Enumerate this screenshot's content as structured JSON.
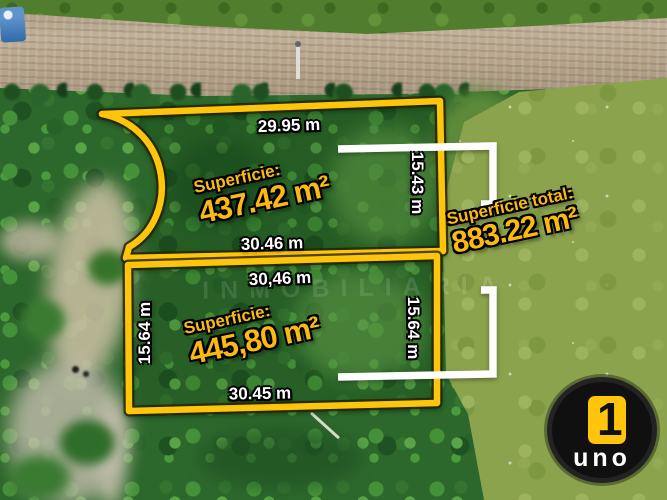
{
  "annotations": {
    "plot1": {
      "top_dim": "29.95 m",
      "right_dim": "15.43 m",
      "bottom_dim": "30.46 m",
      "area_label": "Superficie:",
      "area_value": "437.42 m²"
    },
    "plot2": {
      "top_dim": "30,46 m",
      "left_dim": "15.64 m",
      "right_dim": "15.64 m",
      "bottom_dim": "30.45 m",
      "area_label": "Superficie:",
      "area_value": "445,80 m²"
    },
    "total": {
      "label": "Superficie total:",
      "value": "883.22 m²"
    },
    "watermark": "INMOBILIARIA"
  },
  "logo": {
    "number": "1",
    "text": "uno"
  },
  "colors": {
    "boundary_yellow": "#FFC40C",
    "area_text_yellow": "#FCB912",
    "dimension_white": "#FFFFFF",
    "bracket_white": "#FFFFFF"
  }
}
